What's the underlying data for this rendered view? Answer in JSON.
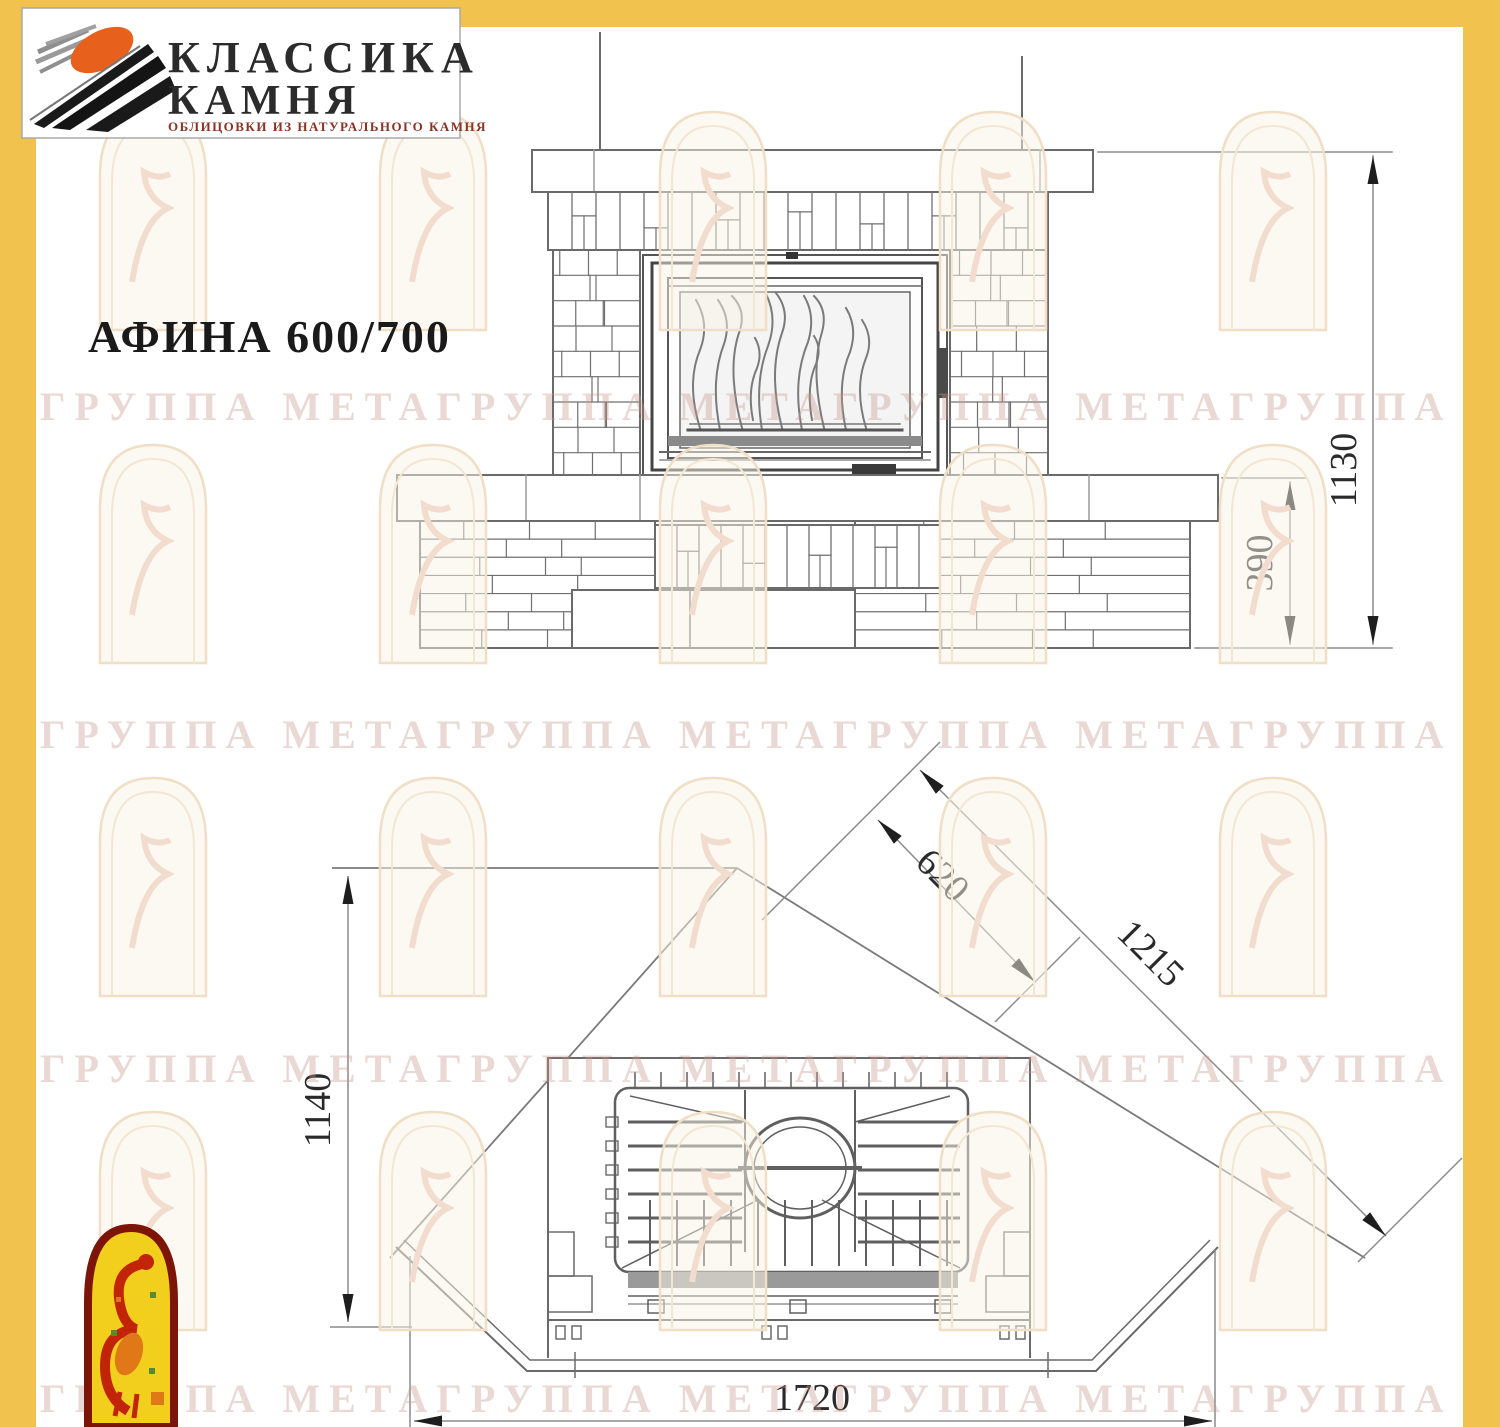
{
  "brand": {
    "name_line1": "КЛАССИКА",
    "name_line2": "КАМНЯ",
    "caption": "ОБЛИЦОВКИ ИЗ НАТУРАЛЬНОГО КАМНЯ"
  },
  "title": "АФИНА 600/700",
  "dimensions": {
    "front_total_height": "1130",
    "front_base_height": "390",
    "plan_depth": "1140",
    "plan_front_width": "1720",
    "plan_side_inner": "620",
    "plan_side_outer": "1215"
  },
  "watermark_text": "ГРУППА МЕТАГРУППА МЕТАГРУППА МЕТАГРУППА МЕТА",
  "colors": {
    "frame_yellow": "#f2c24e",
    "drawing_line": "#6a6a6a",
    "emblem_red": "#8b1a0e",
    "emblem_yellow": "#f2cf1d",
    "logo_orange": "#e8611c"
  }
}
